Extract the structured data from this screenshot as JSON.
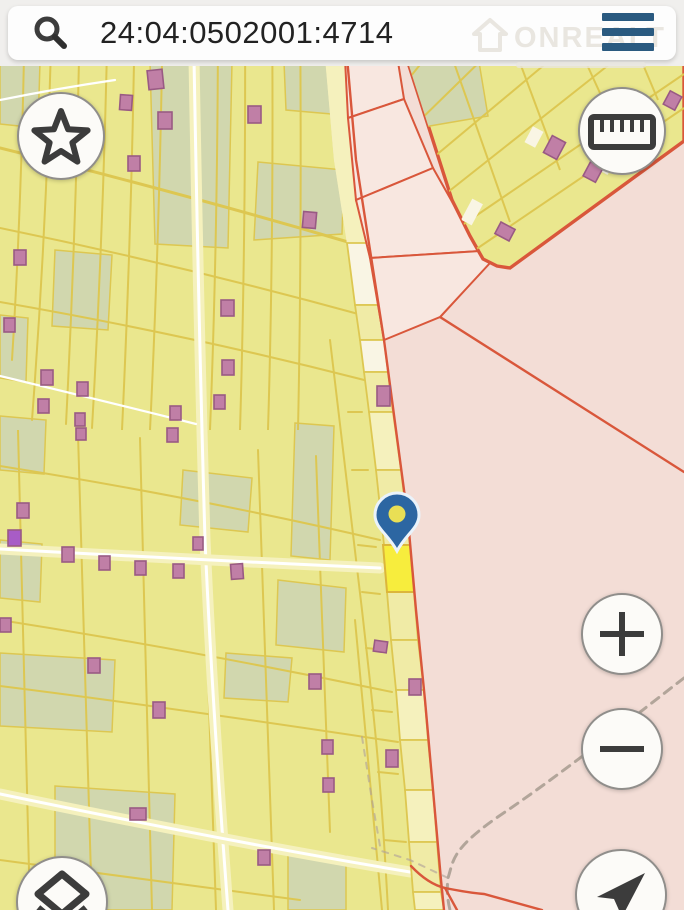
{
  "search": {
    "value": "24:04:0502001:4714",
    "icon": "search-icon"
  },
  "menu": {
    "icon": "hamburger-icon"
  },
  "watermark": {
    "text": "ONREALT",
    "icon": "house-icon"
  },
  "controls": {
    "favorites": {
      "icon": "star-icon"
    },
    "measure": {
      "icon": "ruler-icon"
    },
    "zoom_in": {
      "icon": "plus-icon"
    },
    "zoom_out": {
      "icon": "minus-icon"
    },
    "layers": {
      "icon": "layers-icon"
    },
    "locate": {
      "icon": "navigation-arrow-icon"
    }
  },
  "map": {
    "marker": {
      "present": true,
      "parcel_highlighted": true
    },
    "buildings": [
      [
        148,
        70,
        15,
        19,
        -6
      ],
      [
        120,
        95,
        12,
        15,
        4
      ],
      [
        158,
        112,
        14,
        17,
        0
      ],
      [
        248,
        106,
        13,
        17,
        0
      ],
      [
        128,
        156,
        12,
        15,
        0
      ],
      [
        303,
        212,
        13,
        16,
        5
      ],
      [
        14,
        250,
        12,
        15,
        0
      ],
      [
        221,
        300,
        13,
        16,
        0
      ],
      [
        4,
        318,
        11,
        14,
        0
      ],
      [
        222,
        360,
        12,
        15,
        0
      ],
      [
        41,
        370,
        12,
        15,
        0
      ],
      [
        77,
        382,
        11,
        14,
        0
      ],
      [
        38,
        399,
        11,
        14,
        0
      ],
      [
        75,
        413,
        10,
        13,
        0
      ],
      [
        76,
        428,
        10,
        12,
        0
      ],
      [
        170,
        406,
        11,
        14,
        0
      ],
      [
        167,
        428,
        11,
        14,
        0
      ],
      [
        214,
        395,
        11,
        14,
        0
      ],
      [
        17,
        503,
        12,
        15,
        0
      ],
      [
        8,
        530,
        13,
        16,
        0,
        "v"
      ],
      [
        62,
        547,
        12,
        15,
        0
      ],
      [
        99,
        556,
        11,
        14,
        0
      ],
      [
        135,
        561,
        11,
        14,
        0
      ],
      [
        173,
        564,
        11,
        14,
        0
      ],
      [
        193,
        537,
        10,
        13,
        0
      ],
      [
        231,
        564,
        12,
        15,
        -4
      ],
      [
        0,
        618,
        11,
        14,
        0
      ],
      [
        88,
        658,
        12,
        15,
        0
      ],
      [
        153,
        702,
        12,
        16,
        0
      ],
      [
        309,
        674,
        12,
        15,
        0
      ],
      [
        322,
        740,
        11,
        14,
        0
      ],
      [
        323,
        778,
        11,
        14,
        0
      ],
      [
        130,
        808,
        16,
        12,
        0
      ],
      [
        258,
        850,
        12,
        15,
        0
      ],
      [
        374,
        641,
        13,
        11,
        8
      ],
      [
        409,
        679,
        12,
        16,
        0
      ],
      [
        386,
        750,
        12,
        17,
        0
      ],
      [
        377,
        386,
        13,
        20,
        0
      ],
      [
        547,
        138,
        15,
        19,
        28
      ],
      [
        586,
        164,
        14,
        16,
        28
      ],
      [
        497,
        225,
        16,
        13,
        28
      ],
      [
        666,
        93,
        13,
        15,
        28
      ]
    ]
  },
  "colors": {
    "bar-bg": "#f0efed",
    "pill-bg": "#fdfdfd",
    "search-text": "#222222",
    "icon": "#3c3c3c",
    "btn-bg": "#fcfbf8",
    "btn-border": "#908e8b",
    "menu-blue": "#2a5a80",
    "watermark": "#e9e6e0",
    "yellow-zone": "#eae78e",
    "grid-line": "#ddc751",
    "green-patch": "#d1d7ae",
    "road-pale": "#f5f1bd",
    "parcel-pale": "#f0eba6",
    "parcel-cream": "#f9f5e4",
    "white-road": "#ffffff",
    "pink-zone": "#f3ddd6",
    "pink-light": "#f8e7e0",
    "red-line": "#d9573b",
    "building-fill": "#c07fa6",
    "building-stroke": "#995a84",
    "building-violet": "#a85cc6",
    "selected-fill": "#f7ed3d",
    "selected-stroke": "#dcb63a",
    "pin-blue": "#2c66a2",
    "pin-hole": "#e9df55",
    "dashed-gray": "#b2a59a"
  }
}
